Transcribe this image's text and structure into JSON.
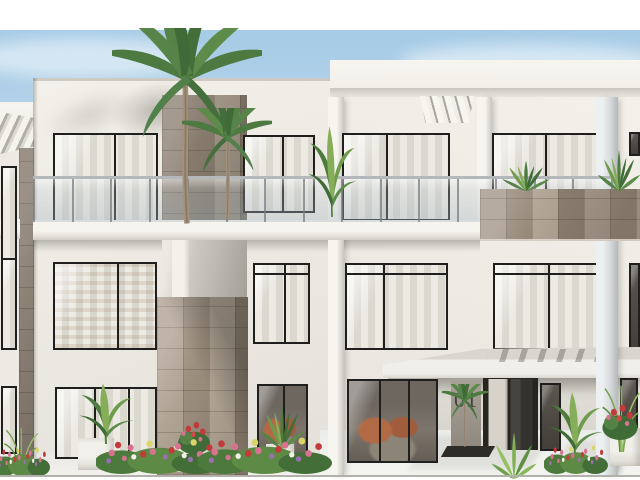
{
  "image": {
    "type": "architectural-render",
    "subject": "Modern white three-storey apartment building with stone-clad tower, black framed windows, glass balcony railings, entrance canopy, palm trees and flowering planters under a pale blue sky",
    "unit_number": "01"
  },
  "palette": {
    "sky_top": "#a6cbe6",
    "sky_low": "#e9f2f8",
    "wall": "#f0ede6",
    "wall_shade": "#dedbd4",
    "stone_light": "#b0a494",
    "stone_dark": "#8b7f70",
    "window_frame": "#1f1f1d",
    "curtain": "#e8e5de",
    "interior_warm": "#b26a45",
    "leaf_dark": "#3f6b38",
    "leaf_mid": "#5d8b49",
    "leaf_light": "#8fae52",
    "flower_pink": "#d7738f",
    "flower_red": "#c23a3a",
    "flower_violet": "#9a6fae",
    "planter_white": "#f2f0ea",
    "paving": "#f3f2ee"
  },
  "layers": {
    "blocks": [
      {
        "n": "sky",
        "c": "sky",
        "x": 0,
        "y": 30,
        "w": 640,
        "h": 447,
        "z": 0
      },
      {
        "n": "cloud-left",
        "c": "cloud",
        "x": -30,
        "y": 38,
        "w": 230,
        "h": 40,
        "z": 0
      },
      {
        "n": "cloud-right",
        "c": "cloud",
        "x": 400,
        "y": 44,
        "w": 260,
        "h": 34,
        "z": 0
      },
      {
        "n": "left-block-wall",
        "c": "wall wall-left",
        "x": 33,
        "y": 78,
        "w": 297,
        "h": 399,
        "z": 1
      },
      {
        "n": "left-roof-edge",
        "c": "roofedge",
        "x": 33,
        "y": 78,
        "w": 297,
        "h": 3,
        "z": 2
      },
      {
        "n": "palm-wall-shadow",
        "c": "softshadow",
        "x": 112,
        "y": 82,
        "w": 86,
        "h": 58,
        "z": 2
      },
      {
        "n": "wall-shade-streak",
        "c": "softshadow2",
        "x": 40,
        "y": 92,
        "w": 100,
        "h": 46,
        "z": 2
      },
      {
        "n": "right-block-wall",
        "c": "wall wall-right",
        "x": 330,
        "y": 60,
        "w": 310,
        "h": 417,
        "z": 1
      },
      {
        "n": "right-roof-fascia",
        "c": "fascia",
        "x": 330,
        "y": 60,
        "w": 310,
        "h": 36,
        "z": 2
      },
      {
        "n": "right-roof-soffit",
        "c": "soffit",
        "x": 330,
        "y": 88,
        "w": 310,
        "h": 9,
        "z": 3
      },
      {
        "n": "left-wing-wall",
        "c": "wall",
        "x": 0,
        "y": 102,
        "w": 37,
        "h": 375,
        "z": 2
      },
      {
        "n": "left-wing-fascia",
        "c": "fascia",
        "x": 0,
        "y": 102,
        "w": 37,
        "h": 30,
        "z": 3
      },
      {
        "n": "left-wing-pergola",
        "c": "pergola",
        "x": 0,
        "y": 112,
        "w": 34,
        "h": 42,
        "z": 4
      },
      {
        "n": "left-wing-slab",
        "c": "slab",
        "x": 0,
        "y": 219,
        "w": 20,
        "h": 20,
        "z": 6
      },
      {
        "n": "left-wing-stone-column",
        "c": "stone stone-col",
        "x": 19,
        "y": 148,
        "w": 15,
        "h": 329,
        "z": 5
      },
      {
        "n": "wing-gap-shadow",
        "c": "gapshadow",
        "x": 33,
        "y": 78,
        "w": 5,
        "h": 399,
        "z": 5
      },
      {
        "n": "louver-fins",
        "c": "louvers",
        "x": 420,
        "y": 96,
        "w": 54,
        "h": 27,
        "z": 6
      },
      {
        "n": "stone-tower-upper",
        "c": "stone stone-up",
        "x": 162,
        "y": 95,
        "w": 85,
        "h": 140,
        "z": 5
      },
      {
        "n": "tower-recess",
        "c": "recess",
        "x": 162,
        "y": 235,
        "w": 85,
        "h": 63,
        "z": 5
      },
      {
        "n": "tower-recess-pier",
        "c": "recesspier",
        "x": 172,
        "y": 235,
        "w": 17,
        "h": 63,
        "z": 5
      },
      {
        "n": "stone-tower-lower",
        "c": "stone stone-low",
        "x": 157,
        "y": 297,
        "w": 91,
        "h": 178,
        "z": 5
      },
      {
        "n": "pier-center",
        "c": "pier",
        "x": 328,
        "y": 97,
        "w": 16,
        "h": 380,
        "z": 6
      },
      {
        "n": "pier-mid-right",
        "c": "pier",
        "x": 477,
        "y": 97,
        "w": 15,
        "h": 127,
        "z": 6
      },
      {
        "n": "pier-right",
        "c": "pier pier-cool",
        "x": 596,
        "y": 97,
        "w": 22,
        "h": 380,
        "z": 9
      },
      {
        "n": "slab-under-shadow",
        "c": "undershadow",
        "x": 33,
        "y": 240,
        "w": 447,
        "h": 12,
        "z": 4
      },
      {
        "n": "canopy-under-shadow",
        "c": "undershadow",
        "x": 388,
        "y": 378,
        "w": 252,
        "h": 16,
        "z": 4
      },
      {
        "n": "paving",
        "c": "paving",
        "x": 0,
        "y": 452,
        "w": 640,
        "h": 25,
        "z": 3
      },
      {
        "n": "entrance-apron",
        "c": "apron",
        "x": 320,
        "y": 430,
        "w": 320,
        "h": 47,
        "z": 3
      },
      {
        "n": "apron-shadow-1",
        "c": "apronshadow",
        "x": 420,
        "y": 436,
        "w": 120,
        "h": 34,
        "z": 3
      },
      {
        "n": "apron-shadow-2",
        "c": "apronshadow",
        "x": 560,
        "y": 440,
        "w": 70,
        "h": 30,
        "z": 3
      },
      {
        "n": "entrance-recess-shade",
        "c": "entrancerecess",
        "x": 438,
        "y": 377,
        "w": 161,
        "h": 79,
        "z": 2
      },
      {
        "n": "unit-sign-panel",
        "c": "signpanel",
        "x": 451,
        "y": 379,
        "w": 30,
        "h": 70,
        "z": 6,
        "bind": "image.unit_number"
      },
      {
        "n": "entrance-door",
        "c": "door",
        "x": 483,
        "y": 376,
        "w": 55,
        "h": 74,
        "z": 7
      },
      {
        "n": "canopy",
        "c": "canopy",
        "x": 383,
        "y": 347,
        "w": 257,
        "h": 31,
        "z": 8
      },
      {
        "n": "canopy-slat-shadows",
        "c": "canopyslats",
        "x": 488,
        "y": 349,
        "w": 120,
        "h": 13,
        "z": 8
      },
      {
        "n": "balcony-slab",
        "c": "slab",
        "x": 33,
        "y": 220,
        "w": 447,
        "h": 20,
        "z": 10
      },
      {
        "n": "stone-parapet",
        "c": "stone parapet",
        "x": 480,
        "y": 189,
        "w": 160,
        "h": 52,
        "z": 11
      },
      {
        "n": "door-planter-bed",
        "c": "doorbed",
        "x": 444,
        "y": 446,
        "w": 48,
        "h": 11,
        "z": 12
      },
      {
        "n": "ground-line",
        "c": "groundline",
        "x": 0,
        "y": 475,
        "w": 640,
        "h": 2,
        "z": 15
      }
    ],
    "windows": [
      {
        "n": "window-wing-top",
        "x": 1,
        "y": 166,
        "w": 16,
        "h": 96,
        "v": "curtain",
        "m": []
      },
      {
        "n": "window-wing-mid",
        "x": 1,
        "y": 258,
        "w": 16,
        "h": 92,
        "v": "curtain",
        "m": []
      },
      {
        "n": "window-wing-ground",
        "x": 1,
        "y": 386,
        "w": 16,
        "h": 68,
        "v": "curtain",
        "m": []
      },
      {
        "n": "window-left-top",
        "x": 53,
        "y": 133,
        "w": 105,
        "h": 90,
        "v": "curtain",
        "m": [
          0.58
        ]
      },
      {
        "n": "window-center-top",
        "x": 243,
        "y": 135,
        "w": 72,
        "h": 78,
        "v": "curtain",
        "m": [
          0.54
        ]
      },
      {
        "n": "window-right-top-a",
        "x": 342,
        "y": 133,
        "w": 108,
        "h": 88,
        "v": "curtain",
        "m": [
          0.4
        ]
      },
      {
        "n": "window-right-top-b",
        "x": 492,
        "y": 133,
        "w": 106,
        "h": 88,
        "v": "curtain",
        "m": [
          0.5
        ]
      },
      {
        "n": "window-right-top-edge",
        "x": 629,
        "y": 132,
        "w": 11,
        "h": 24,
        "v": "dark",
        "m": []
      },
      {
        "n": "window-left-mid",
        "x": 53,
        "y": 262,
        "w": 104,
        "h": 88,
        "v": "curtain-warm",
        "m": [
          0.62
        ]
      },
      {
        "n": "window-center-mid",
        "x": 253,
        "y": 263,
        "w": 57,
        "h": 81,
        "v": "curtain",
        "m": [
          0.54
        ],
        "hm": 0.1
      },
      {
        "n": "window-right-mid-a",
        "x": 345,
        "y": 263,
        "w": 103,
        "h": 87,
        "v": "curtain",
        "m": [
          0.36
        ],
        "hm": 0.1
      },
      {
        "n": "window-right-mid-b",
        "x": 493,
        "y": 263,
        "w": 105,
        "h": 87,
        "v": "curtain",
        "m": [
          0.52
        ],
        "hm": 0.1
      },
      {
        "n": "window-right-mid-edge",
        "x": 629,
        "y": 263,
        "w": 11,
        "h": 87,
        "v": "dark",
        "m": []
      },
      {
        "n": "window-left-ground",
        "x": 55,
        "y": 387,
        "w": 102,
        "h": 72,
        "v": "curtain",
        "m": [
          0.38,
          0.72
        ]
      },
      {
        "n": "window-center-ground",
        "x": 257,
        "y": 384,
        "w": 51,
        "h": 76,
        "v": "interior-warm",
        "m": [
          0.5
        ]
      },
      {
        "n": "window-right-ground-a",
        "x": 347,
        "y": 379,
        "w": 91,
        "h": 84,
        "v": "interior-warm",
        "m": [
          0.34,
          0.68
        ]
      },
      {
        "n": "window-right-ground-side",
        "x": 540,
        "y": 383,
        "w": 21,
        "h": 68,
        "v": "dark",
        "m": []
      },
      {
        "n": "window-right-ground-edge",
        "x": 620,
        "y": 378,
        "w": 18,
        "h": 79,
        "v": "dark",
        "m": []
      }
    ],
    "railing": {
      "n": "balcony-railing-glass",
      "x": 33,
      "y": 176,
      "w": 580,
      "h": 46,
      "posts": 15
    },
    "planters": [
      {
        "n": "planter-box-left",
        "x": 78,
        "y": 438,
        "w": 36,
        "h": 32
      },
      {
        "n": "planter-pot-center",
        "x": 266,
        "y": 444,
        "w": 28,
        "h": 28
      },
      {
        "n": "planter-trough-tower",
        "x": 174,
        "y": 446,
        "w": 36,
        "h": 26
      },
      {
        "n": "planter-box-right",
        "x": 610,
        "y": 428,
        "w": 30,
        "h": 38
      }
    ],
    "plants": [
      {
        "t": "palm",
        "n": "palm-tree-large",
        "x": 112,
        "y": 28,
        "w": 150,
        "h": 200,
        "z": 12
      },
      {
        "t": "palm",
        "n": "palm-tree-small",
        "x": 182,
        "y": 108,
        "w": 90,
        "h": 115,
        "z": 12,
        "f": true
      },
      {
        "t": "banana",
        "n": "balcony-banana-plant",
        "x": 306,
        "y": 112,
        "w": 52,
        "h": 108,
        "z": 12
      },
      {
        "t": "leafy",
        "n": "parapet-plant-left",
        "x": 498,
        "y": 150,
        "w": 56,
        "h": 42,
        "z": 12
      },
      {
        "t": "leafy",
        "n": "parapet-plant-right",
        "x": 594,
        "y": 136,
        "w": 50,
        "h": 56,
        "z": 12
      },
      {
        "t": "grass",
        "n": "grass-right",
        "x": 598,
        "y": 380,
        "w": 46,
        "h": 72,
        "z": 13
      },
      {
        "t": "grass",
        "n": "grass-far-left",
        "x": 0,
        "y": 424,
        "w": 42,
        "h": 52,
        "z": 13
      },
      {
        "t": "palm",
        "n": "entrance-palm-plant",
        "x": 442,
        "y": 384,
        "w": 46,
        "h": 64,
        "z": 13
      },
      {
        "t": "fan",
        "n": "entrance-fan-plant",
        "x": 486,
        "y": 418,
        "w": 56,
        "h": 62,
        "z": 13
      },
      {
        "t": "banana",
        "n": "doorside-tropical-plant",
        "x": 546,
        "y": 382,
        "w": 58,
        "h": 78,
        "z": 13
      },
      {
        "t": "banana",
        "n": "planter-plant-left",
        "x": 76,
        "y": 374,
        "w": 60,
        "h": 72,
        "z": 13
      },
      {
        "t": "leafy",
        "n": "planter-plant-center",
        "x": 256,
        "y": 388,
        "w": 52,
        "h": 62,
        "z": 13
      },
      {
        "t": "rose",
        "n": "tower-front-flowers",
        "x": 174,
        "y": 414,
        "w": 40,
        "h": 42,
        "z": 13
      },
      {
        "t": "flowers",
        "n": "flowerbed-left",
        "x": 96,
        "y": 428,
        "w": 126,
        "h": 46,
        "z": 14
      },
      {
        "t": "flowers",
        "n": "flowerbed-center",
        "x": 198,
        "y": 426,
        "w": 134,
        "h": 48,
        "z": 14
      },
      {
        "t": "flowers",
        "n": "flowerbed-door-right",
        "x": 544,
        "y": 436,
        "w": 64,
        "h": 38,
        "z": 14
      },
      {
        "t": "rose",
        "n": "planter-roses-right",
        "x": 598,
        "y": 396,
        "w": 44,
        "h": 46,
        "z": 14
      },
      {
        "t": "flowers",
        "n": "flowerbed-far-left",
        "x": -6,
        "y": 438,
        "w": 56,
        "h": 38,
        "z": 14
      }
    ]
  }
}
